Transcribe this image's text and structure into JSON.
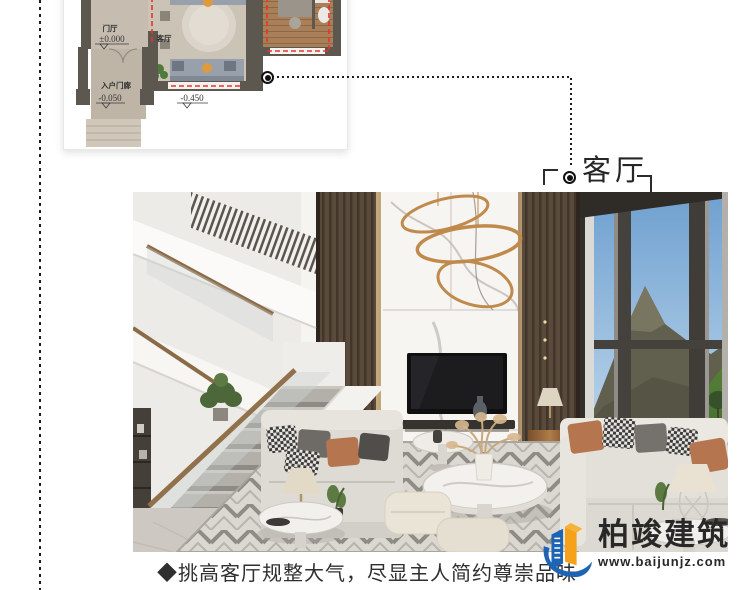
{
  "colors": {
    "plan_outline_red": "#e8322e",
    "connector_black": "#1c1c1c",
    "logo_blue": "#1d64b5",
    "logo_orange": "#f5a21a",
    "accent_wood": "#8a6a47"
  },
  "floor_plan": {
    "labels": {
      "foyer": "门厅",
      "foyer_level": "±0.000",
      "living": "客厅",
      "living_level": "-0.450",
      "porch": "入户门廊",
      "porch_level": "-0.050"
    }
  },
  "callout": {
    "label": "客厅"
  },
  "caption": "◆挑高客厅规整大气，尽显主人简约尊崇品味",
  "logo": {
    "name": "柏竣建筑",
    "website": "www.baijunjz.com"
  }
}
